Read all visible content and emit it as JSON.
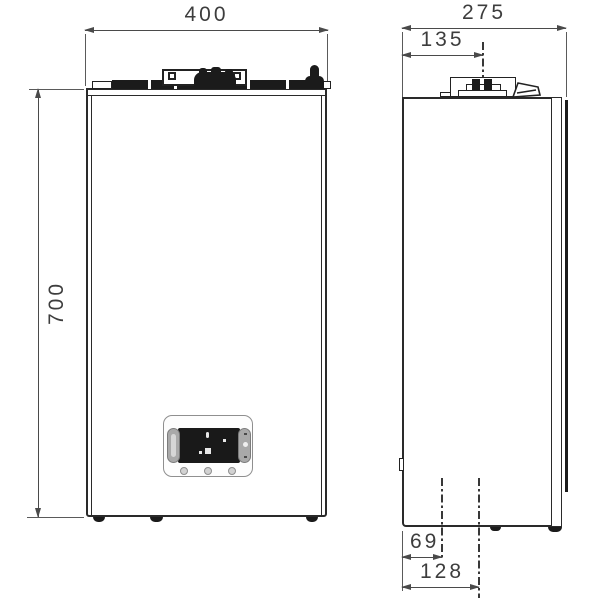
{
  "dims": {
    "front_width": "400",
    "front_height": "700",
    "side_depth": "275",
    "flue_offset": "135",
    "bottom_offset_small": "69",
    "bottom_offset_large": "128"
  },
  "colors": {
    "outline": "#2a2a2a",
    "dimension_line": "#4a4a4a",
    "dimension_text": "#3d3d3d",
    "dark_fill": "#1b1b1b",
    "panel_border": "#8f8f8f",
    "display": "#191919",
    "background": "#ffffff"
  }
}
